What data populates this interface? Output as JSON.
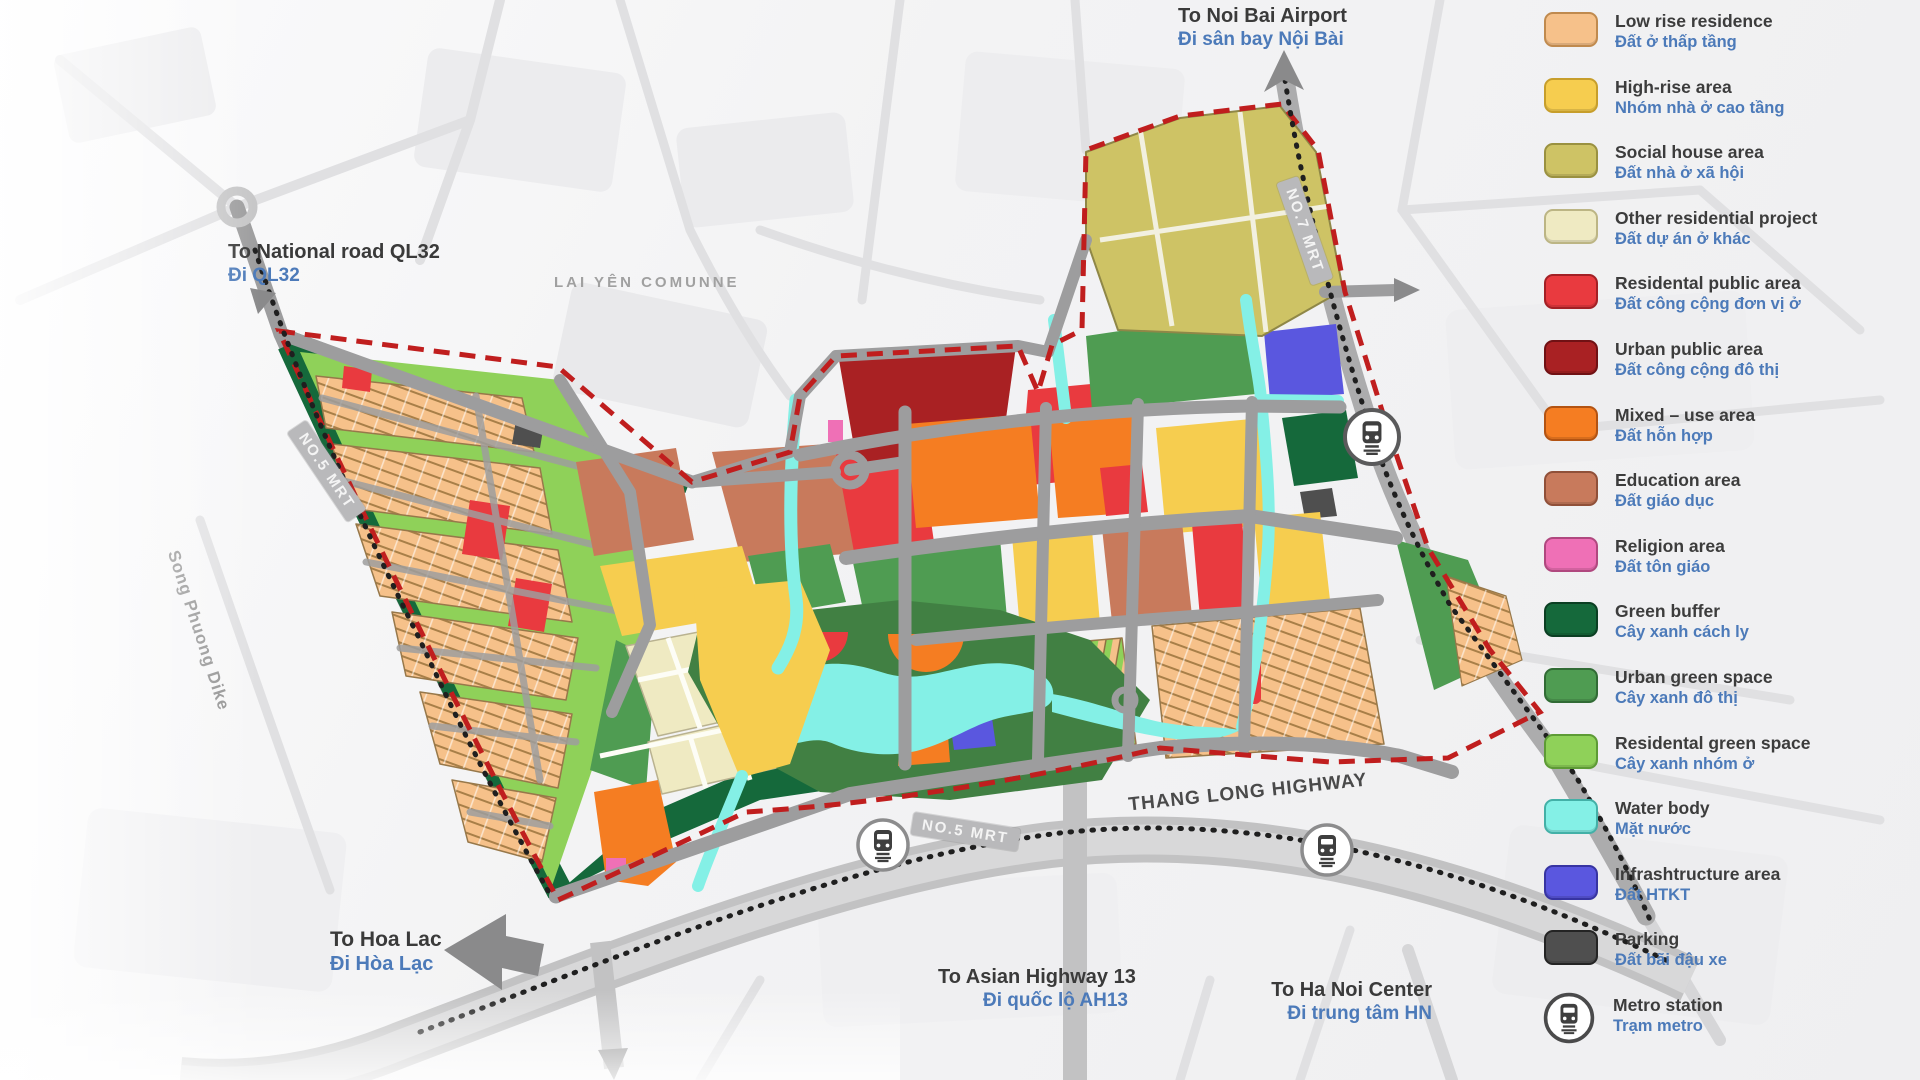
{
  "legend": {
    "items": [
      {
        "en": "Low rise residence",
        "vi": "Đất ở thấp tầng",
        "color": "#F6C18A",
        "border": "#C08A4E"
      },
      {
        "en": "High-rise area",
        "vi": "Nhóm nhà ở cao tầng",
        "color": "#F6CD4F",
        "border": "#C79E2B"
      },
      {
        "en": "Social house area",
        "vi": "Đất nhà ở xã hội",
        "color": "#CEC365",
        "border": "#9A9140"
      },
      {
        "en": "Other residential project",
        "vi": "Đất dự án ở khác",
        "color": "#EFEAC2",
        "border": "#BCB584"
      },
      {
        "en": "Residental public area",
        "vi": "Đất công cộng đơn vị ở",
        "color": "#E93A3F",
        "border": "#A32025"
      },
      {
        "en": "Urban public area",
        "vi": "Đất công cộng đô thị",
        "color": "#A92123",
        "border": "#701114"
      },
      {
        "en": "Mixed – use area",
        "vi": "Đất hỗn hợp",
        "color": "#F57D22",
        "border": "#B35312"
      },
      {
        "en": "Education area",
        "vi": "Đất giáo dục",
        "color": "#C87A5C",
        "border": "#905039"
      },
      {
        "en": "Religion area",
        "vi": "Đất tôn giáo",
        "color": "#EF70B6",
        "border": "#B0487F"
      },
      {
        "en": "Green buffer",
        "vi": "Cây xanh cách ly",
        "color": "#15693B",
        "border": "#0B3F23"
      },
      {
        "en": "Urban green space",
        "vi": "Cây xanh đô thị",
        "color": "#4F9C52",
        "border": "#316B35"
      },
      {
        "en": "Residental green space",
        "vi": "Cây xanh nhóm ở",
        "color": "#8FD159",
        "border": "#5D9B35"
      },
      {
        "en": "Water body",
        "vi": "Mặt nước",
        "color": "#84F0E6",
        "border": "#43B0A7"
      },
      {
        "en": "Infrashtructure area",
        "vi": "Đất HTKT",
        "color": "#5A57DF",
        "border": "#3734A2"
      },
      {
        "en": "Parking",
        "vi": "Đất bãi đậu xe",
        "color": "#4F4F4F",
        "border": "#242424"
      },
      {
        "en": "Metro station",
        "vi": "Trạm metro",
        "icon": "metro-station-icon"
      }
    ]
  },
  "directions": {
    "airport": {
      "en": "To Noi Bai Airport",
      "vi": "Đi sân bay Nội Bài"
    },
    "ql32": {
      "en": "To National road QL32",
      "vi": "Đi QL32"
    },
    "hoa_lac": {
      "en": "To Hoa Lac",
      "vi": "Đi Hòa Lạc"
    },
    "ah13": {
      "en": "To Asian Highway 13",
      "vi": "Đi quốc lộ AH13"
    },
    "hanoi": {
      "en": "To Ha Noi Center",
      "vi": "Đi trung tâm HN"
    }
  },
  "roads": {
    "thang_long": "THANG LONG HIGHWAY",
    "no5": "NO.5 MRT",
    "no7": "NO.7 MRT"
  },
  "areas": {
    "lai_yen": "LAI YÊN COMUNNE",
    "song_phuong": "Song Phuong Dike"
  }
}
